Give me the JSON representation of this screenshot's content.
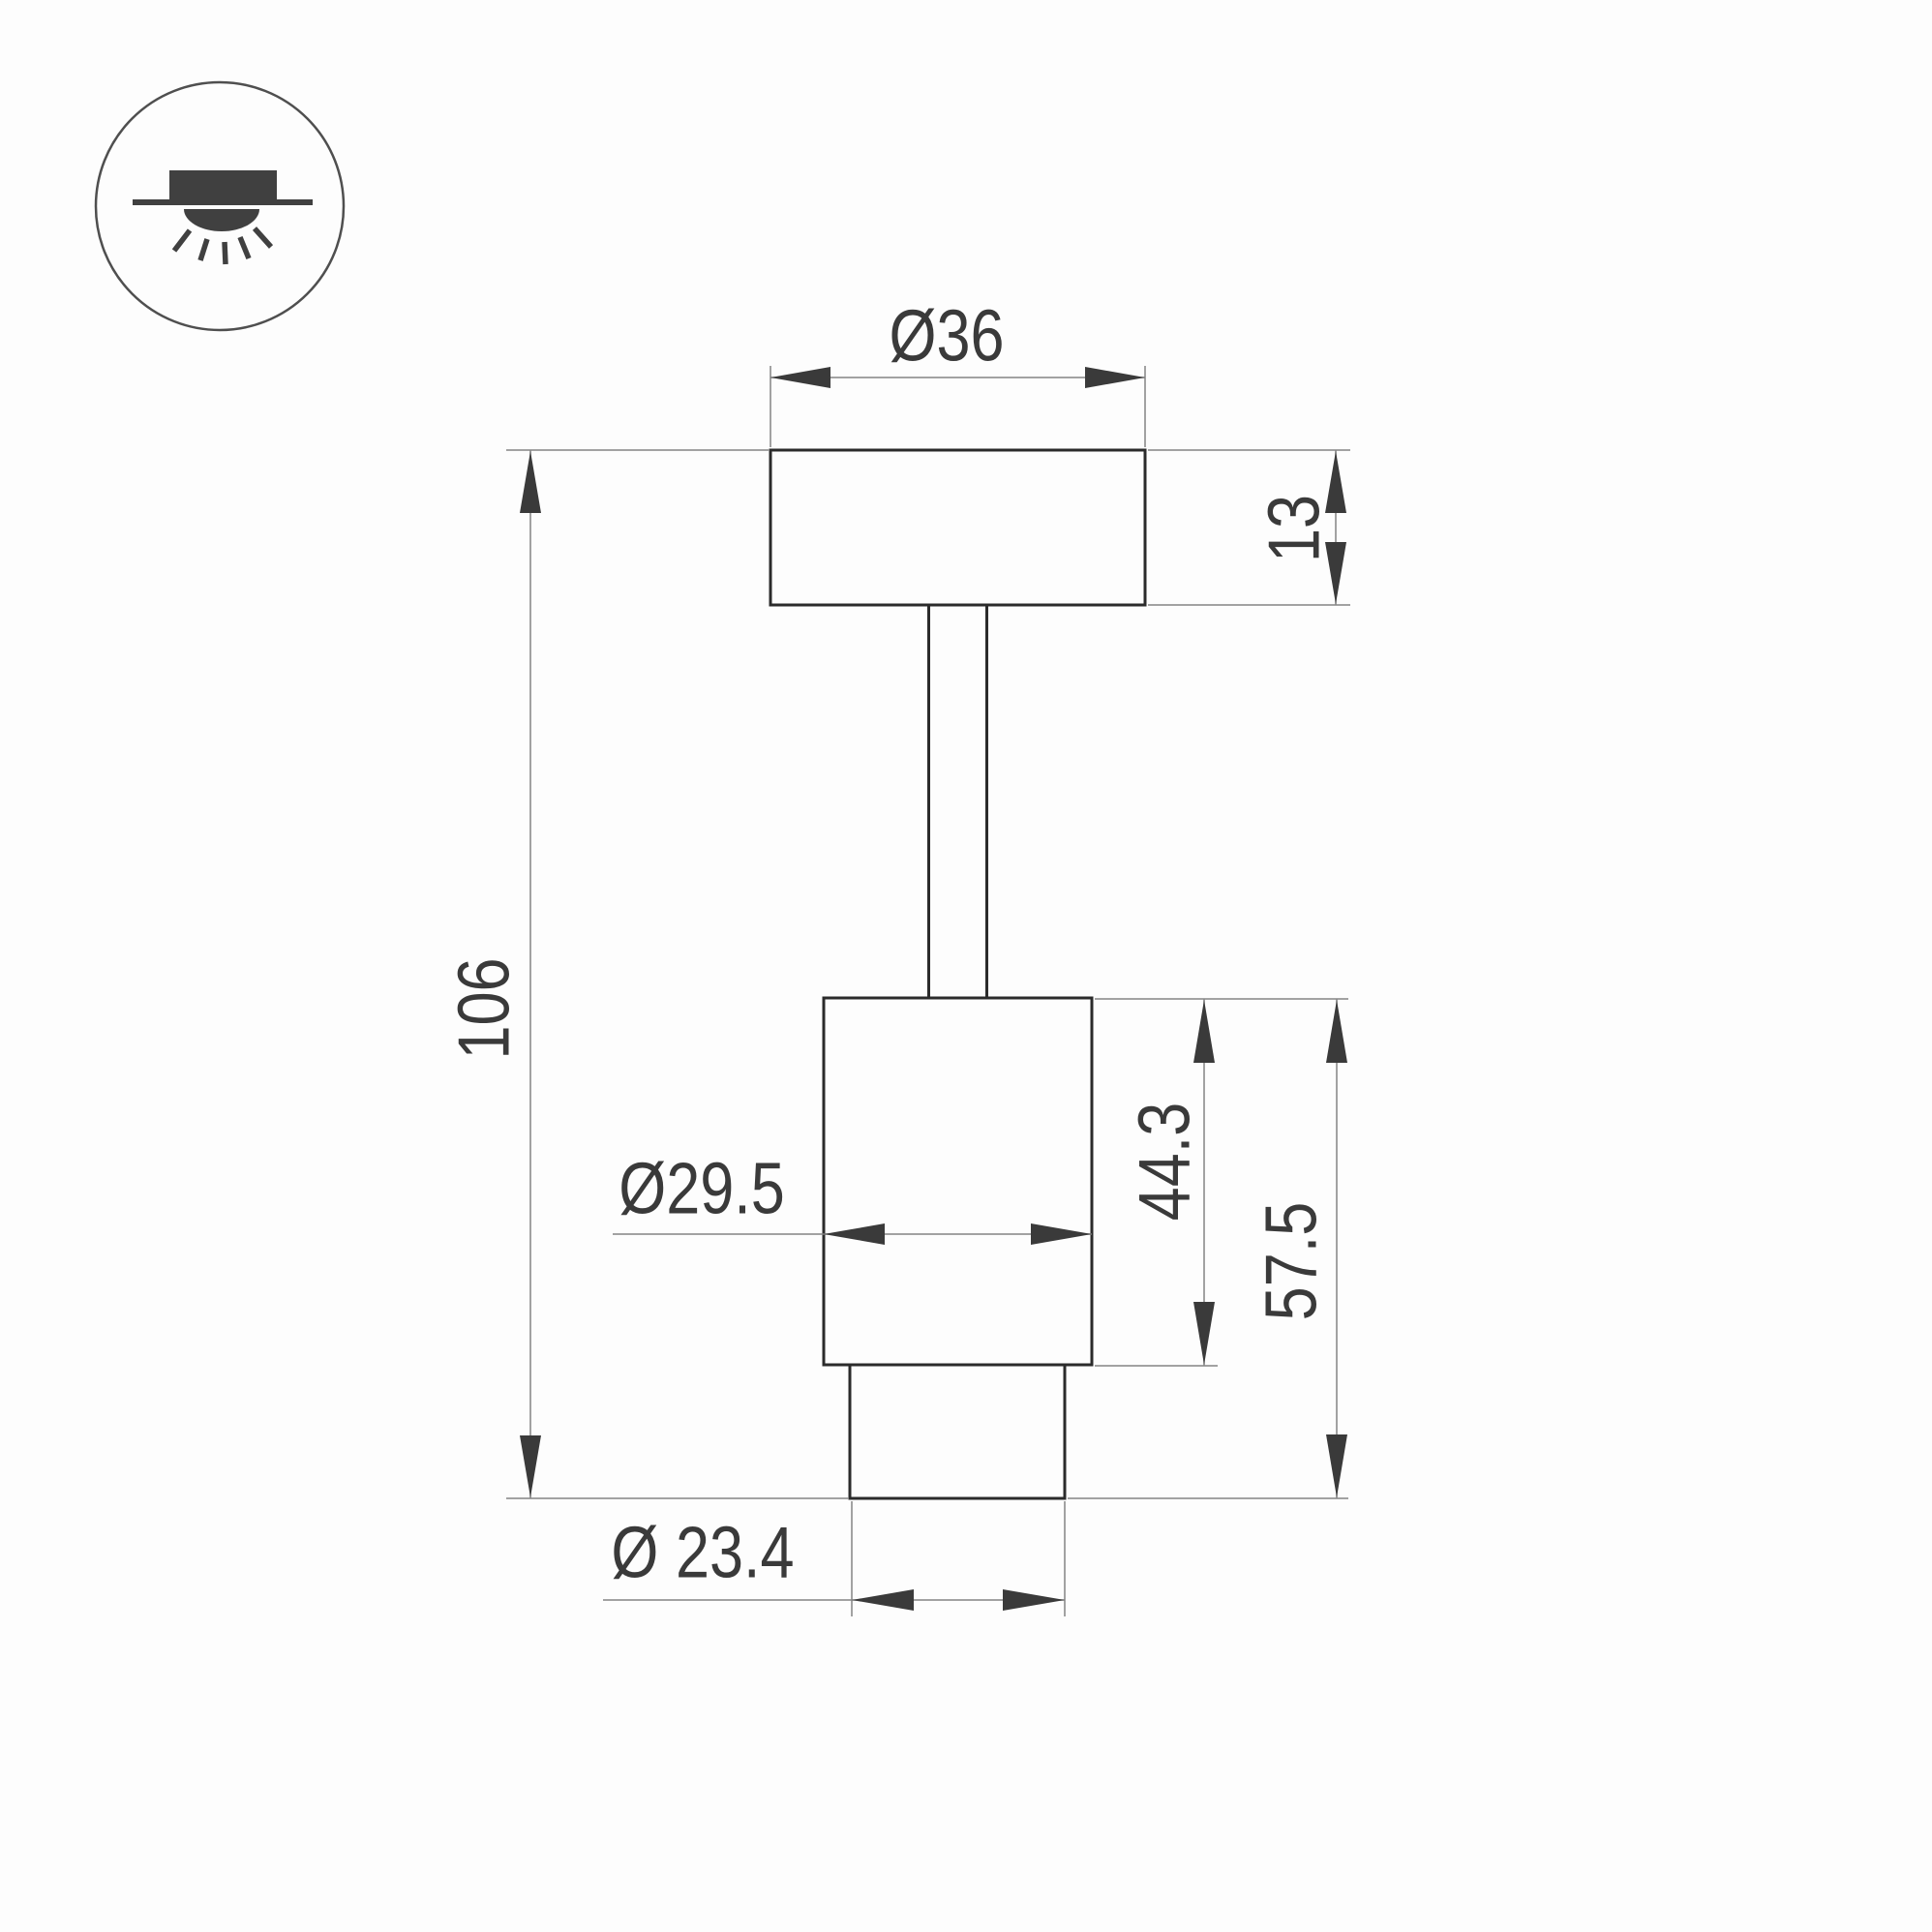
{
  "drawing": {
    "type": "technical-dimension-drawing",
    "subject": "ceiling surface-mounted spot luminaire, side view",
    "icon": {
      "name": "surface-ceiling-light-icon",
      "description": "circle badge with surface-mounted downlight glyph: box above ceiling line, light dome and rays below"
    },
    "labels": {
      "top_diameter": "Ø36",
      "plate_height": "13",
      "overall_height": "106",
      "body_diameter": "Ø29.5",
      "body_height": "44.3",
      "lower_height": "57.5",
      "nozzle_diameter": "Ø 23.4"
    },
    "colors": {
      "background": "#fdfdfd",
      "outline": "#2b2b2b",
      "dimension": "#848484",
      "text": "#3a3a3a",
      "icon": "#404040",
      "icon_circle": "#4f4f4f"
    }
  }
}
